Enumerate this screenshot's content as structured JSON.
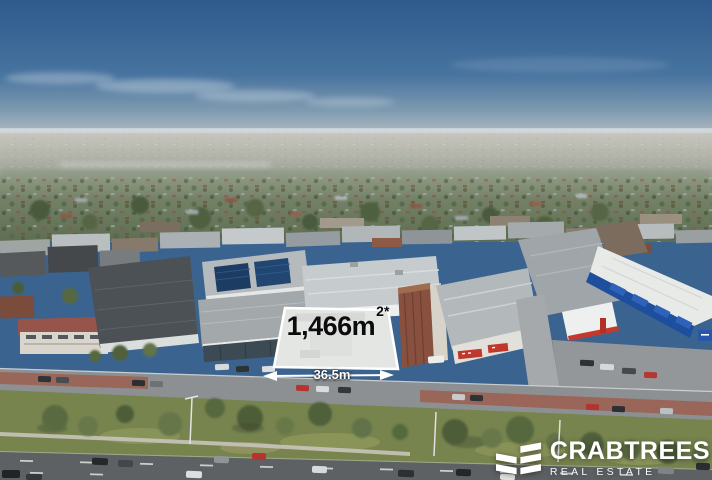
{
  "site": {
    "area_value": "1,466m",
    "area_superscript": "2*",
    "frontage": "36.5m"
  },
  "branding": {
    "name": "CRABTREES",
    "tagline": "REAL ESTATE"
  },
  "colors": {
    "boundary_overlay": "#ffffff",
    "area_text": "#0c0c0c",
    "frontage_text": "#ffffff",
    "logo_text": "#ffffff",
    "sky_top": "#2e5a8d",
    "sky_horizon": "#a7b4bd",
    "grass_verge": "#77844e",
    "road_asphalt": "#8d9092",
    "brick_paving": "#9c5f4f"
  }
}
